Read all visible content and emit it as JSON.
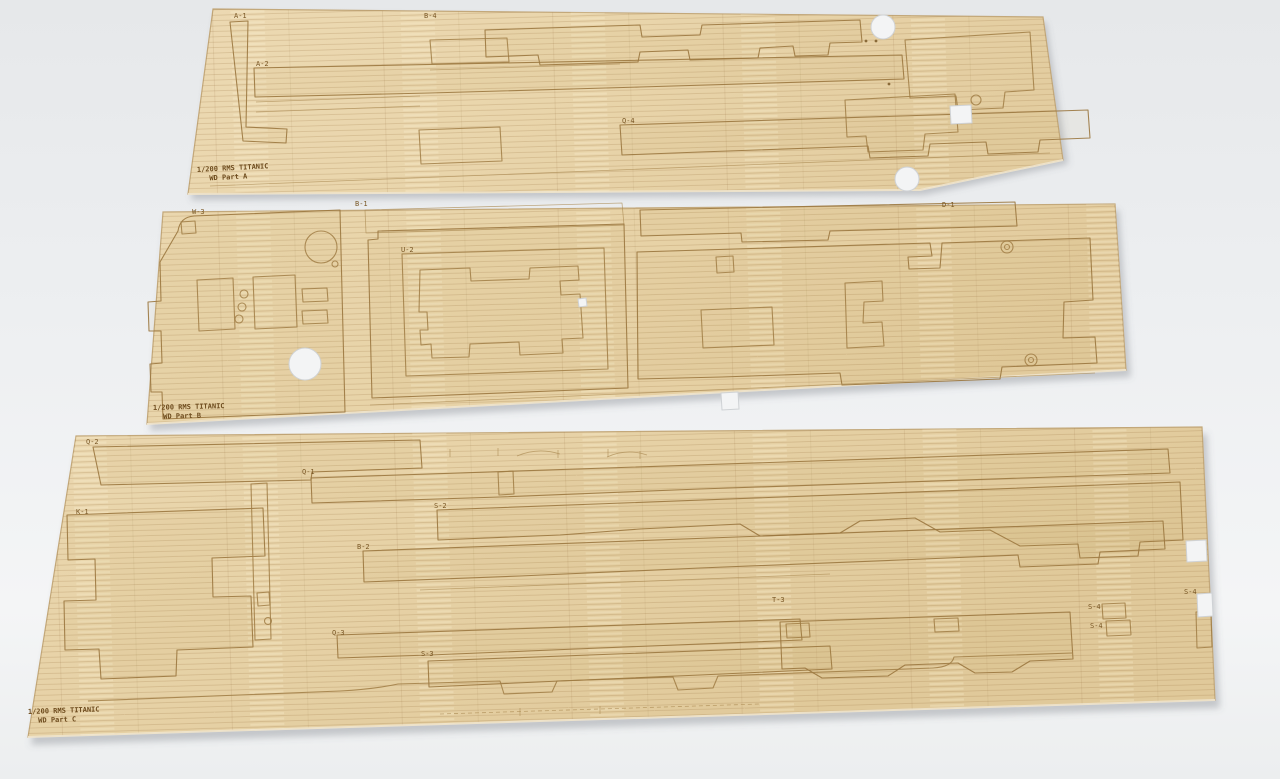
{
  "scene": {
    "background_color": "#edeff1",
    "wood_color_light": "#eddbb5",
    "wood_color_base": "#e8d4aa",
    "wood_color_dark": "#dfc89c",
    "etch_color": "#a07c44",
    "burn_text_color": "#6e4c1e",
    "hole_color": "#f3f4f5"
  },
  "sheets": [
    {
      "id": "sheet-a",
      "inscription_line1": "1/200 RMS TITANIC",
      "inscription_line2": "WD Part A",
      "labels": [
        "A-1",
        "A-2",
        "B-4",
        "Q-4"
      ]
    },
    {
      "id": "sheet-b",
      "inscription_line1": "1/200 RMS TITANIC",
      "inscription_line2": "WD Part B",
      "labels": [
        "W-3",
        "B-1",
        "U-2",
        "D-1"
      ]
    },
    {
      "id": "sheet-c",
      "inscription_line1": "1/200 RMS TITANIC",
      "inscription_line2": "WD Part C",
      "labels": [
        "Q-2",
        "K-1",
        "Q-1",
        "S-2",
        "B-2",
        "Q-3",
        "S-3",
        "T-3",
        "S-4",
        "S-4",
        "S-4"
      ]
    }
  ]
}
